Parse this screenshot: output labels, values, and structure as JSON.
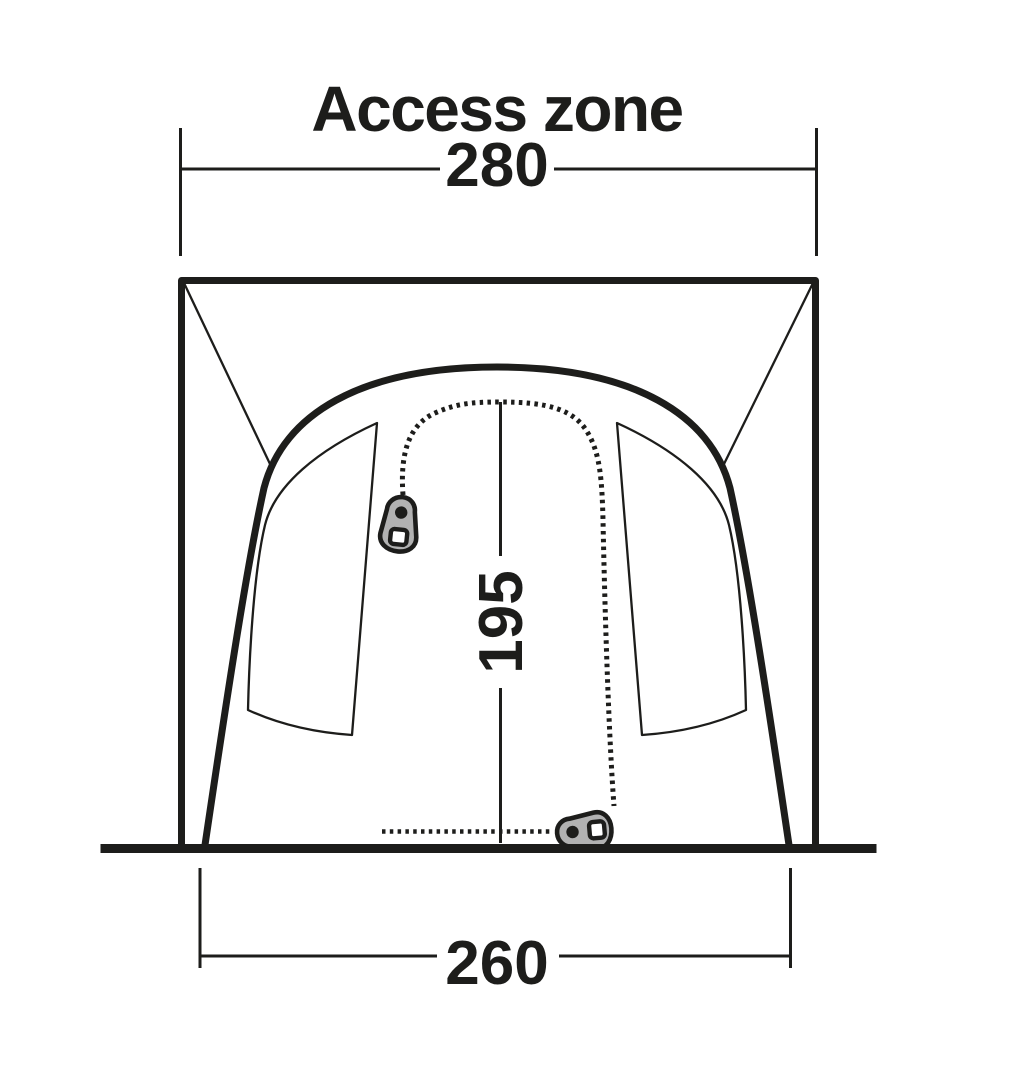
{
  "title": "Access zone",
  "diagram": {
    "subject": "tent access zone front elevation with measurements",
    "dimensions": {
      "top_width": "280",
      "door_height": "195",
      "bottom_width": "260"
    },
    "colors": {
      "line": "#1d1d1b",
      "zipper_pull_fill": "#b2b2b2",
      "background": "#ffffff"
    }
  }
}
